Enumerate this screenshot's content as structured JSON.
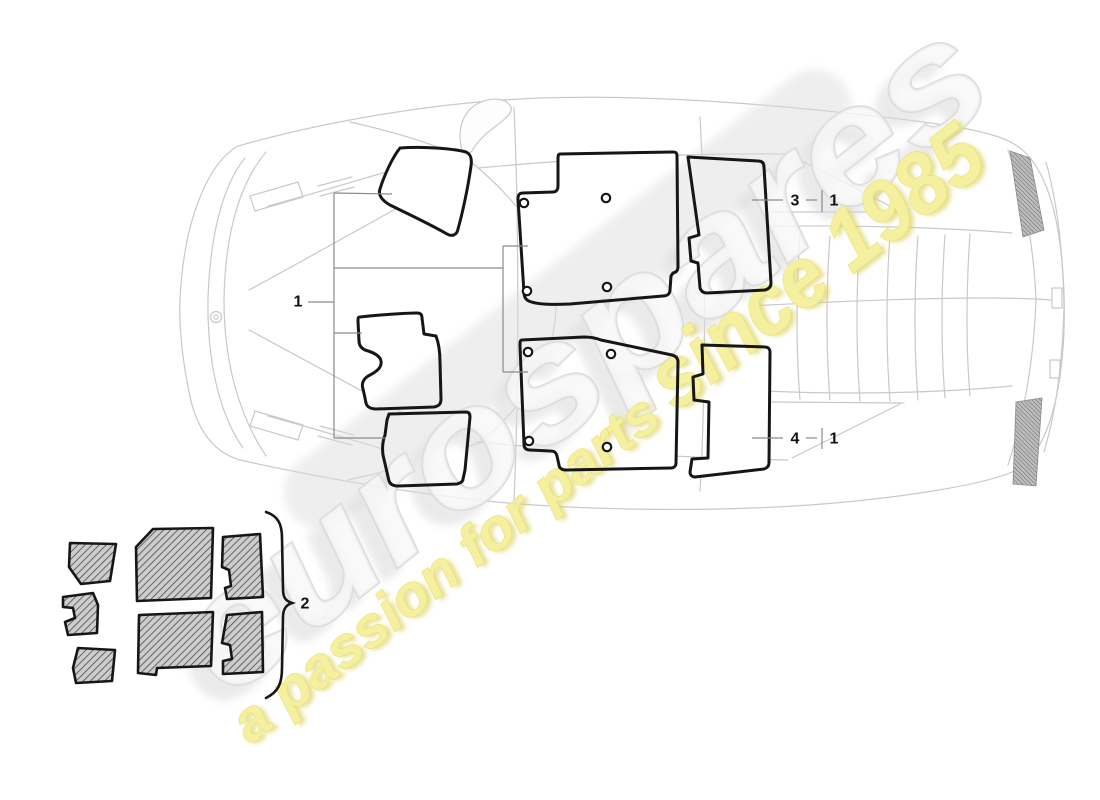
{
  "diagram": {
    "callouts": {
      "group1_label": "1",
      "group2_label": "2",
      "item3_label": "3",
      "item3_ref": "1",
      "item4_label": "4",
      "item4_ref": "1"
    },
    "watermark": {
      "brand": "eurospares",
      "tagline_lead": "a passion for parts",
      "tagline_tail": "since 1985",
      "brand_fill": "#f7f7f7",
      "brand_stroke": "#dcdcdc",
      "brand_shadow": "#dadada",
      "tagline_fill": "#f5efa0",
      "tagline_stroke": "#e7de62",
      "tagline_shadow": "#ddd46a"
    },
    "colors": {
      "part_outline": "#161616",
      "car_line": "#c9c9c9",
      "leader_line": "#8a8a8a",
      "label_color": "#111111",
      "hatch_bg": "#cdcdcd",
      "hatch_line": "#4a4a4a",
      "grille_bg": "#bdbdbd",
      "grille_line": "#6a6a6a"
    }
  }
}
